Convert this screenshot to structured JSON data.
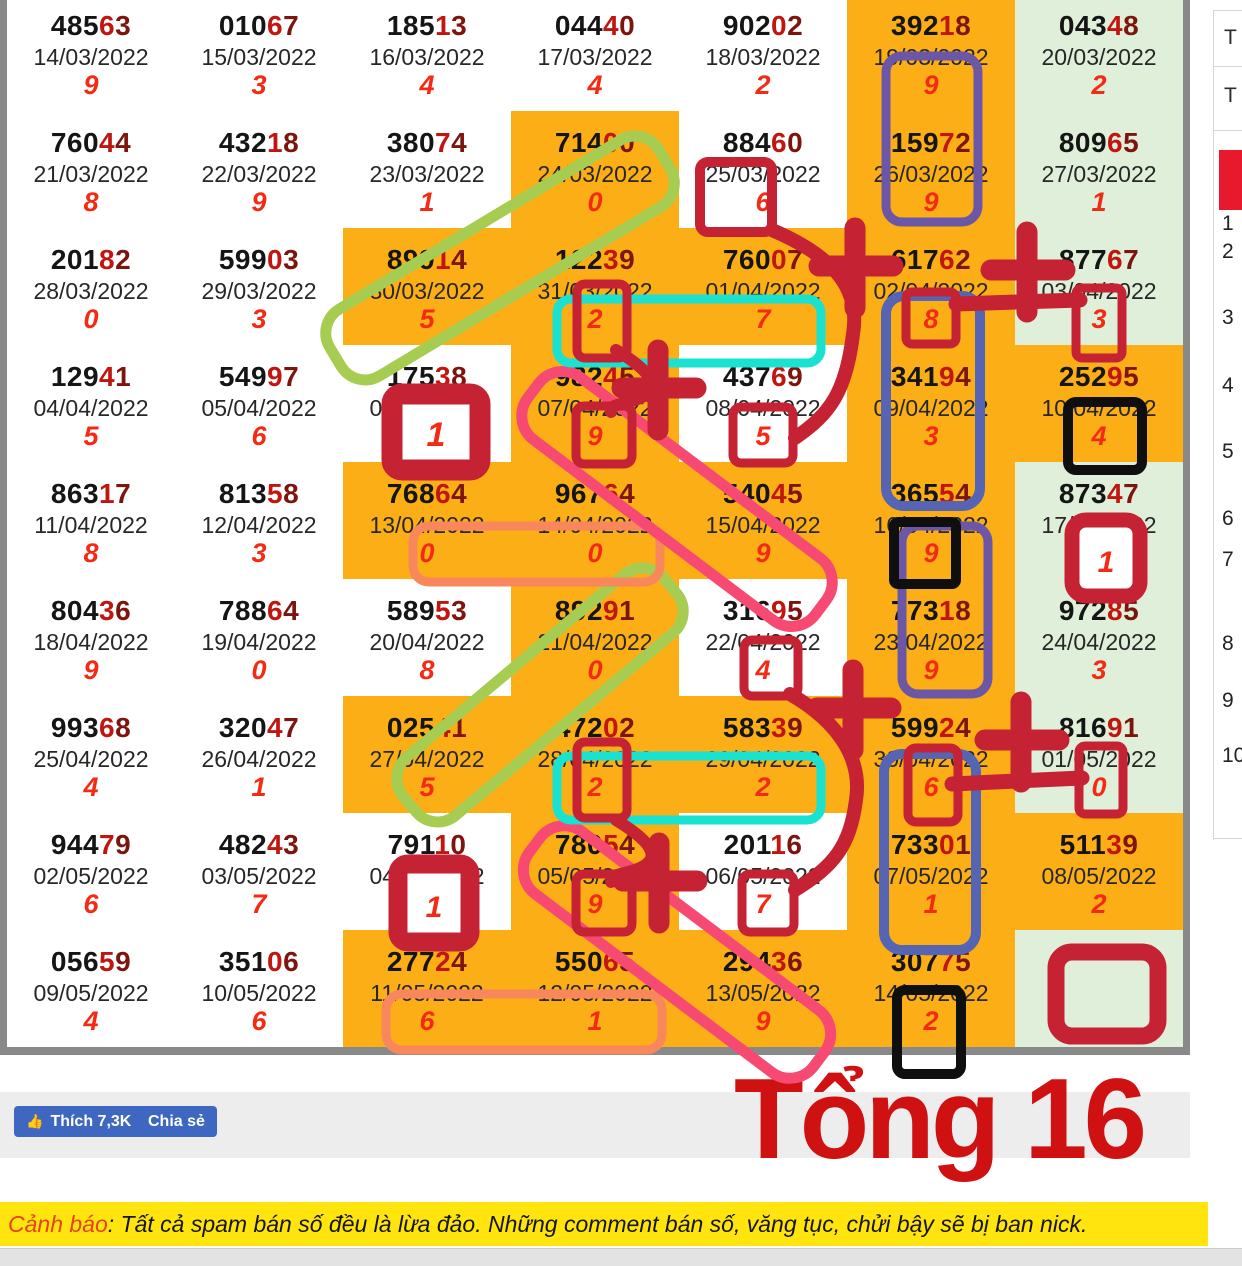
{
  "colors": {
    "cell_orange": "#fcae17",
    "cell_green": "#e0efda",
    "cell_white": "#ffffff",
    "number_black": "#151515",
    "number_red4": "#c1150f",
    "number_maroon5": "#7d150f",
    "sum_digit_red": "#f32a14",
    "anno_crimson": "#c52334",
    "anno_pink": "#f64a72",
    "anno_salmon": "#f8885c",
    "anno_cyan": "#19e2d0",
    "anno_green": "#a6cd51",
    "anno_purple": "#6c57a6",
    "anno_blue": "#5565b4",
    "anno_black": "#0f0f0f",
    "fb_blue": "#3e67c2",
    "banner_yellow": "#ffe40e",
    "banner_red": "#e74118",
    "big_text_red": "#d01111",
    "panel_red_block": "#e8192c"
  },
  "lottery_table": {
    "rows": [
      {
        "cells": [
          {
            "n": "48563",
            "d": "14/03/2022",
            "g": "9",
            "bg": "w"
          },
          {
            "n": "01067",
            "d": "15/03/2022",
            "g": "3",
            "bg": "w"
          },
          {
            "n": "18513",
            "d": "16/03/2022",
            "g": "4",
            "bg": "w"
          },
          {
            "n": "04440",
            "d": "17/03/2022",
            "g": "4",
            "bg": "w"
          },
          {
            "n": "90202",
            "d": "18/03/2022",
            "g": "2",
            "bg": "w"
          },
          {
            "n": "39218",
            "d": "19/03/2022",
            "g": "9",
            "bg": "o"
          },
          {
            "n": "04348",
            "d": "20/03/2022",
            "g": "2",
            "bg": "g"
          }
        ]
      },
      {
        "cells": [
          {
            "n": "76044",
            "d": "21/03/2022",
            "g": "8",
            "bg": "w"
          },
          {
            "n": "43218",
            "d": "22/03/2022",
            "g": "9",
            "bg": "w"
          },
          {
            "n": "38074",
            "d": "23/03/2022",
            "g": "1",
            "bg": "w"
          },
          {
            "n": "71400",
            "d": "24/03/2022",
            "g": "0",
            "bg": "o"
          },
          {
            "n": "88460",
            "d": "25/03/2022",
            "g": "6",
            "bg": "w"
          },
          {
            "n": "15972",
            "d": "26/03/2022",
            "g": "9",
            "bg": "o"
          },
          {
            "n": "80965",
            "d": "27/03/2022",
            "g": "1",
            "bg": "g"
          }
        ]
      },
      {
        "cells": [
          {
            "n": "20182",
            "d": "28/03/2022",
            "g": "0",
            "bg": "w"
          },
          {
            "n": "59903",
            "d": "29/03/2022",
            "g": "3",
            "bg": "w"
          },
          {
            "n": "89914",
            "d": "30/03/2022",
            "g": "5",
            "bg": "o"
          },
          {
            "n": "12239",
            "d": "31/03/2022",
            "g": "2",
            "bg": "o"
          },
          {
            "n": "76007",
            "d": "01/04/2022",
            "g": "7",
            "bg": "o"
          },
          {
            "n": "61762",
            "d": "02/04/2022",
            "g": "8",
            "bg": "o"
          },
          {
            "n": "87767",
            "d": "03/04/2022",
            "g": "3",
            "bg": "g"
          }
        ]
      },
      {
        "cells": [
          {
            "n": "12941",
            "d": "04/04/2022",
            "g": "5",
            "bg": "w"
          },
          {
            "n": "54997",
            "d": "05/04/2022",
            "g": "6",
            "bg": "w"
          },
          {
            "n": "17538",
            "d": "06/04/2022",
            "g": "1",
            "bg": "w"
          },
          {
            "n": "98245",
            "d": "07/04/2022",
            "g": "9",
            "bg": "o"
          },
          {
            "n": "43769",
            "d": "08/04/2022",
            "g": "5",
            "bg": "w"
          },
          {
            "n": "34194",
            "d": "09/04/2022",
            "g": "3",
            "bg": "o"
          },
          {
            "n": "25295",
            "d": "10/04/2022",
            "g": "4",
            "bg": "o"
          }
        ]
      },
      {
        "cells": [
          {
            "n": "86317",
            "d": "11/04/2022",
            "g": "8",
            "bg": "w"
          },
          {
            "n": "81358",
            "d": "12/04/2022",
            "g": "3",
            "bg": "w"
          },
          {
            "n": "76864",
            "d": "13/04/2022",
            "g": "0",
            "bg": "o"
          },
          {
            "n": "96764",
            "d": "14/04/2022",
            "g": "0",
            "bg": "o"
          },
          {
            "n": "54045",
            "d": "15/04/2022",
            "g": "9",
            "bg": "o"
          },
          {
            "n": "36554",
            "d": "16/04/2022",
            "g": "9",
            "bg": "o"
          },
          {
            "n": "87347",
            "d": "17/04/2022",
            "g": "1",
            "bg": "g"
          }
        ]
      },
      {
        "cells": [
          {
            "n": "80436",
            "d": "18/04/2022",
            "g": "9",
            "bg": "w"
          },
          {
            "n": "78864",
            "d": "19/04/2022",
            "g": "0",
            "bg": "w"
          },
          {
            "n": "58953",
            "d": "20/04/2022",
            "g": "8",
            "bg": "w"
          },
          {
            "n": "89291",
            "d": "21/04/2022",
            "g": "0",
            "bg": "o"
          },
          {
            "n": "31695",
            "d": "22/04/2022",
            "g": "4",
            "bg": "w"
          },
          {
            "n": "77318",
            "d": "23/04/2022",
            "g": "9",
            "bg": "o"
          },
          {
            "n": "97285",
            "d": "24/04/2022",
            "g": "3",
            "bg": "g"
          }
        ]
      },
      {
        "cells": [
          {
            "n": "99368",
            "d": "25/04/2022",
            "g": "4",
            "bg": "w"
          },
          {
            "n": "32047",
            "d": "26/04/2022",
            "g": "1",
            "bg": "w"
          },
          {
            "n": "02541",
            "d": "27/04/2022",
            "g": "5",
            "bg": "o"
          },
          {
            "n": "47202",
            "d": "28/04/2022",
            "g": "2",
            "bg": "o"
          },
          {
            "n": "58339",
            "d": "29/04/2022",
            "g": "2",
            "bg": "o"
          },
          {
            "n": "59924",
            "d": "30/04/2022",
            "g": "6",
            "bg": "o"
          },
          {
            "n": "81691",
            "d": "01/05/2022",
            "g": "0",
            "bg": "g"
          }
        ]
      },
      {
        "cells": [
          {
            "n": "94479",
            "d": "02/05/2022",
            "g": "6",
            "bg": "w"
          },
          {
            "n": "48243",
            "d": "03/05/2022",
            "g": "7",
            "bg": "w"
          },
          {
            "n": "79110",
            "d": "04/05/2022",
            "g": "1",
            "bg": "w"
          },
          {
            "n": "78054",
            "d": "05/05/2022",
            "g": "9",
            "bg": "o"
          },
          {
            "n": "20116",
            "d": "06/05/2022",
            "g": "7",
            "bg": "w"
          },
          {
            "n": "73301",
            "d": "07/05/2022",
            "g": "1",
            "bg": "o"
          },
          {
            "n": "51139",
            "d": "08/05/2022",
            "g": "2",
            "bg": "o"
          }
        ]
      },
      {
        "cells": [
          {
            "n": "05659",
            "d": "09/05/2022",
            "g": "4",
            "bg": "w"
          },
          {
            "n": "35106",
            "d": "10/05/2022",
            "g": "6",
            "bg": "w"
          },
          {
            "n": "27724",
            "d": "11/05/2022",
            "g": "6",
            "bg": "o"
          },
          {
            "n": "55065",
            "d": "12/05/2022",
            "g": "1",
            "bg": "o"
          },
          {
            "n": "29436",
            "d": "13/05/2022",
            "g": "9",
            "bg": "o"
          },
          {
            "n": "30775",
            "d": "14/05/2022",
            "g": "2",
            "bg": "o"
          },
          {
            "n": "",
            "d": "",
            "g": "",
            "bg": "g"
          }
        ]
      }
    ]
  },
  "side_panel": {
    "t_labels": [
      "T",
      "T"
    ],
    "list_numbers": [
      "1",
      "2",
      "3",
      "4",
      "5",
      "6",
      "7",
      "8",
      "9",
      "10"
    ]
  },
  "annotations": {
    "box_labels": [
      "1",
      "1",
      "1"
    ]
  },
  "fb_bar": {
    "like_label": "Thích 7,3K",
    "share_label": "Chia sẻ",
    "thumb_icon": "👍"
  },
  "big_text": "Tổng 16",
  "warning": {
    "label": "Cảnh báo",
    "text": ": Tất cả spam bán số đều là lừa đảo. Những comment bán số, văng tục, chửi bậy sẽ bị ban nick."
  }
}
